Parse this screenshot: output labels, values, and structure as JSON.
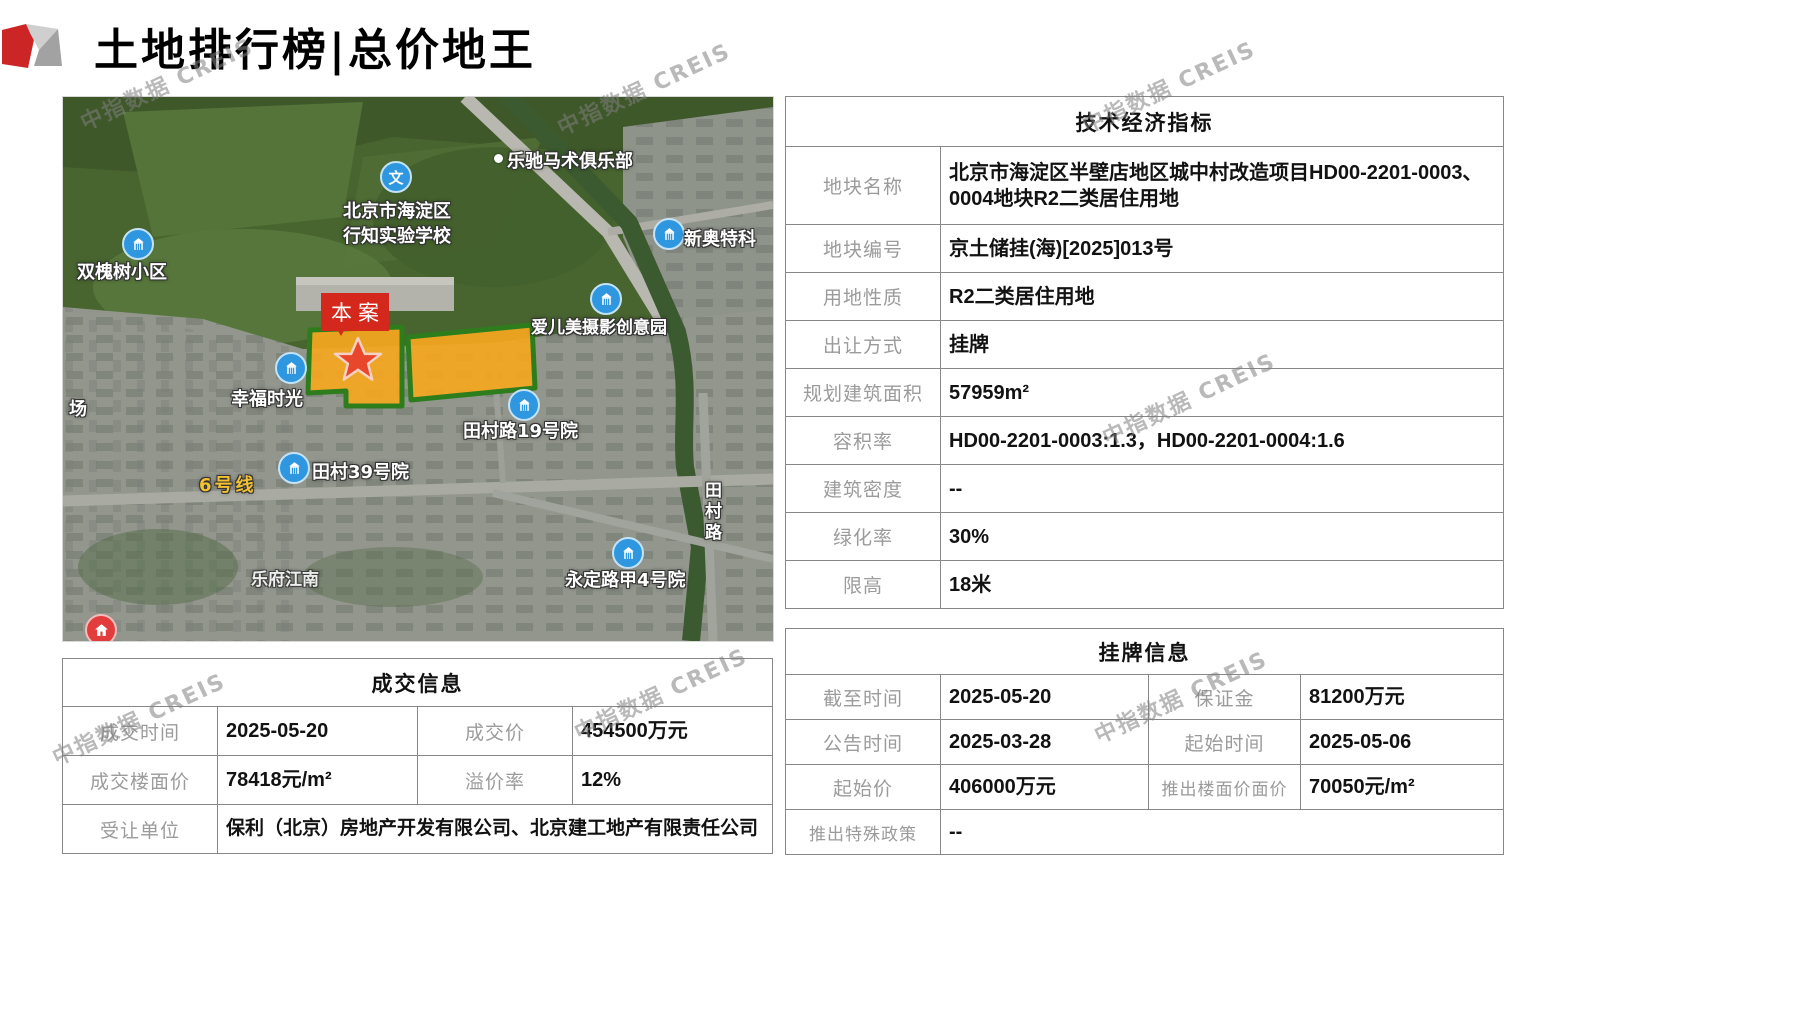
{
  "title": "土地排行榜|总价地王",
  "watermark": "中指数据 CREIS",
  "map": {
    "case_label": "本案",
    "labels": {
      "club": "乐驰马术俱乐部",
      "school": "北京市海淀区行知实验学校",
      "shuanghuaishu": "双槐树小区",
      "xinaote": "新奥特科",
      "aiermei": "爱儿美摄影创意园",
      "xingfu": "幸福时光",
      "chang": "场",
      "tiancunlu19": "田村路19号院",
      "tiancun39": "田村39号院",
      "line6": "6号线",
      "tiancunlu": "田村路",
      "lefu": "乐府江南",
      "yongding": "永定路甲4号院"
    }
  },
  "tech_table": {
    "title": "技术经济指标",
    "rows": [
      {
        "label": "地块名称",
        "value": "北京市海淀区半壁店地区城中村改造项目HD00-2201-0003、0004地块R2二类居住用地"
      },
      {
        "label": "地块编号",
        "value": "京土储挂(海)[2025]013号"
      },
      {
        "label": "用地性质",
        "value": "R2二类居住用地"
      },
      {
        "label": "出让方式",
        "value": "挂牌"
      },
      {
        "label": "规划建筑面积",
        "value": "57959m²"
      },
      {
        "label": "容积率",
        "value": "HD00-2201-0003:1.3，HD00-2201-0004:1.6"
      },
      {
        "label": "建筑密度",
        "value": "--"
      },
      {
        "label": "绿化率",
        "value": "30%"
      },
      {
        "label": "限高",
        "value": "18米"
      }
    ]
  },
  "deal_table": {
    "title": "成交信息",
    "deal_time_label": "成交时间",
    "deal_time": "2025-05-20",
    "deal_price_label": "成交价",
    "deal_price": "454500万元",
    "floor_price_label": "成交楼面价",
    "floor_price": "78418元/m²",
    "premium_label": "溢价率",
    "premium": "12%",
    "transferee_label": "受让单位",
    "transferee": "保利（北京）房地产开发有限公司、北京建工地产有限责任公司"
  },
  "listing_table": {
    "title": "挂牌信息",
    "deadline_label": "截至时间",
    "deadline": "2025-05-20",
    "deposit_label": "保证金",
    "deposit": "81200万元",
    "announce_label": "公告时间",
    "announce": "2025-03-28",
    "start_time_label": "起始时间",
    "start_time": "2025-05-06",
    "start_price_label": "起始价",
    "start_price": "406000万元",
    "launch_floor_label": "推出楼面价面价",
    "launch_floor": "70050元/m²",
    "policy_label": "推出特殊政策",
    "policy": "--"
  }
}
